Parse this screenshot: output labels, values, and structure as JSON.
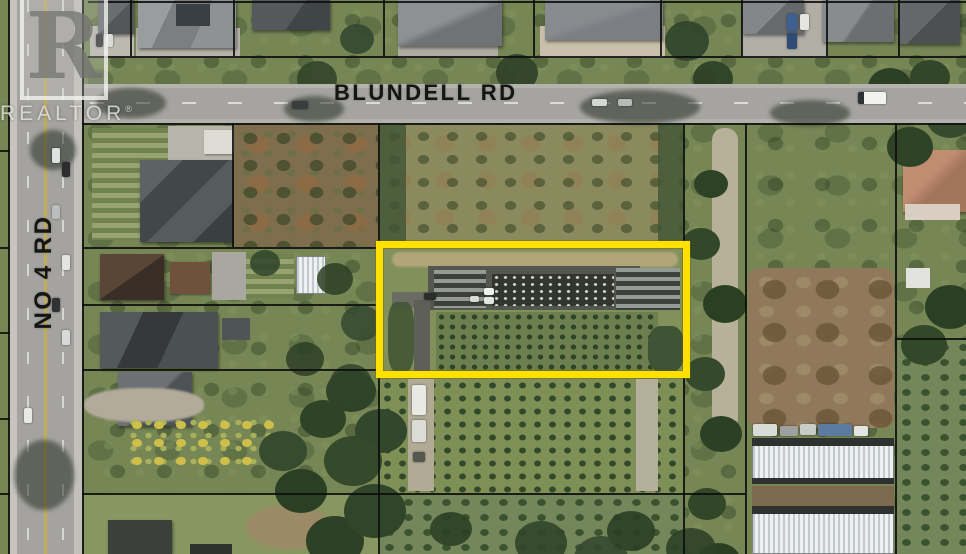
{
  "scene": {
    "kind": "aerial-satellite-property-photo",
    "highlight_outline_color": "#FFE100"
  },
  "roads": {
    "blundell": {
      "label": "BLUNDELL RD"
    },
    "no4": {
      "label": "NO 4 RD"
    }
  },
  "watermark": {
    "logo_letter": "R",
    "brand": "REALTOR",
    "registered_mark": "®"
  }
}
